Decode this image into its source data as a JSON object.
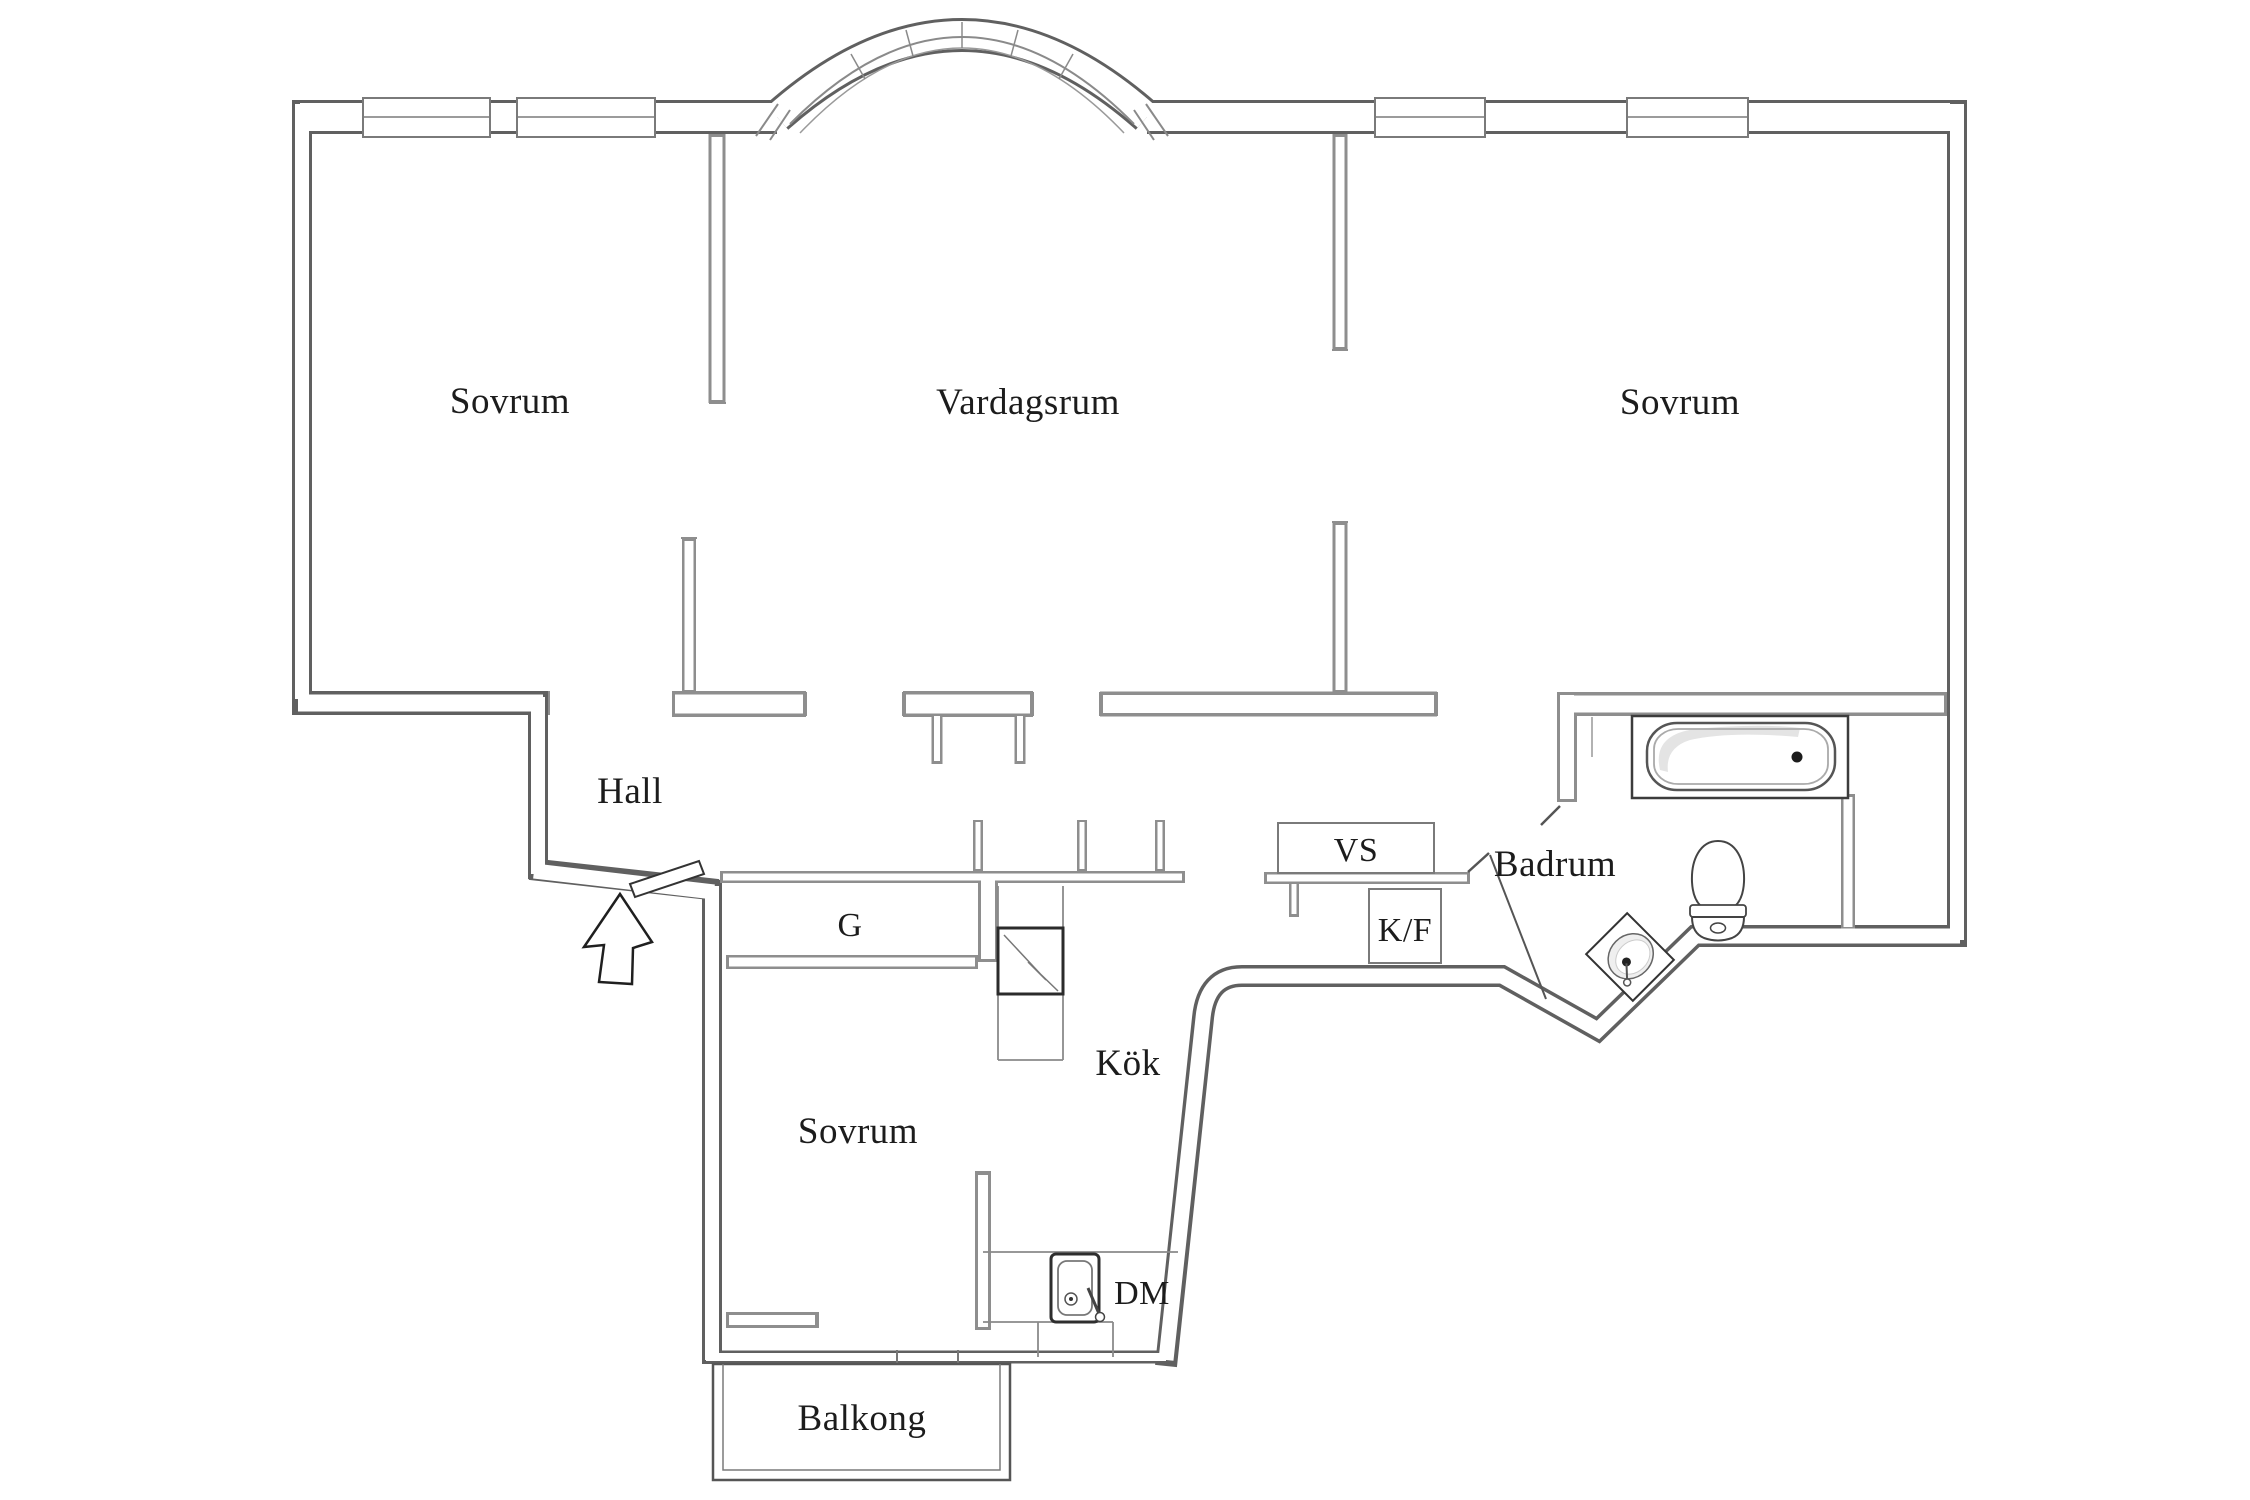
{
  "title": "Apartment floor plan",
  "rooms": {
    "bedroom_top_left": "Sovrum",
    "living_room": "Vardagsrum",
    "bedroom_top_right": "Sovrum",
    "hall": "Hall",
    "kitchen": "Kök",
    "bathroom": "Badrum",
    "bedroom_bottom": "Sovrum",
    "balcony": "Balkong"
  },
  "labels": {
    "wardrobe": "G",
    "vs_unit": "VS",
    "fridge_freezer": "K/F",
    "dishwasher": "DM"
  },
  "fixtures": [
    "bathtub",
    "toilet",
    "washbasin",
    "kitchen-sink",
    "entrance-arrow",
    "entrance-door",
    "bathroom-door",
    "electric-panel",
    "arched-bay-window",
    "window"
  ],
  "colors": {
    "background": "#ffffff",
    "exterior_wall": "#606060",
    "partition_wall": "#8e8e8e",
    "fixture_line": "#444444",
    "text": "#1c1c1c"
  }
}
